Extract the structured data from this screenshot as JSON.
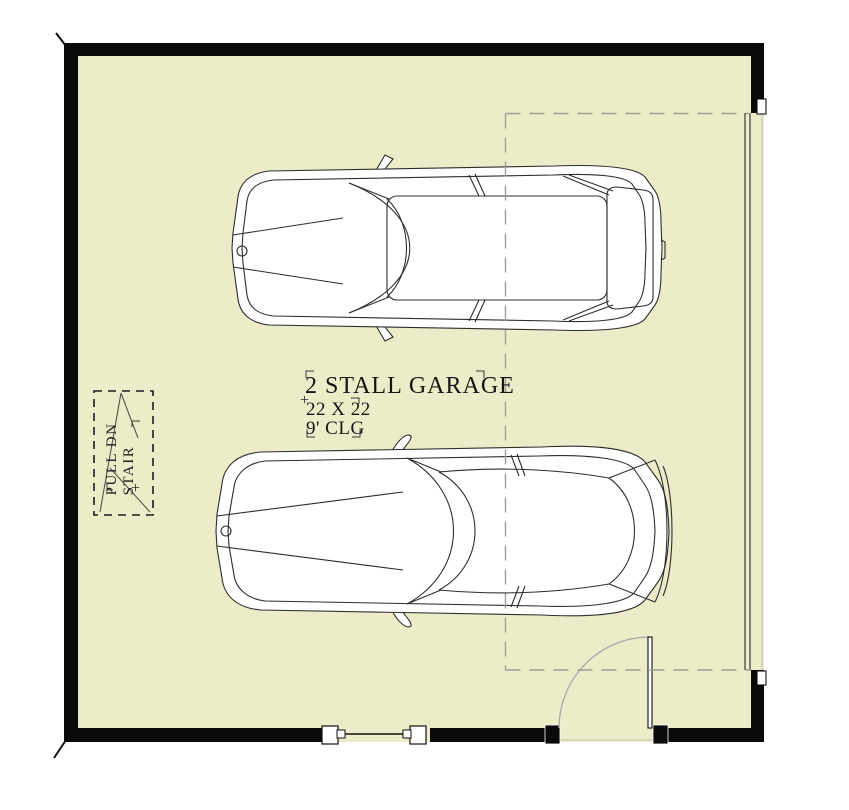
{
  "plan": {
    "title": "2 STALL GARAGE",
    "size_label": "22 X 22",
    "ceiling_label": "9' CLG",
    "insertion_marker": "+",
    "stair": {
      "line1": "PULL DN",
      "line2": "STAIR",
      "marker": "+"
    },
    "colors": {
      "floor": "#ECECC9",
      "wall": "#0a0a0a",
      "bay_dash": "#9f9f94",
      "car_line": "#2d2d2d",
      "door_arc": "#a8a8a8"
    }
  }
}
